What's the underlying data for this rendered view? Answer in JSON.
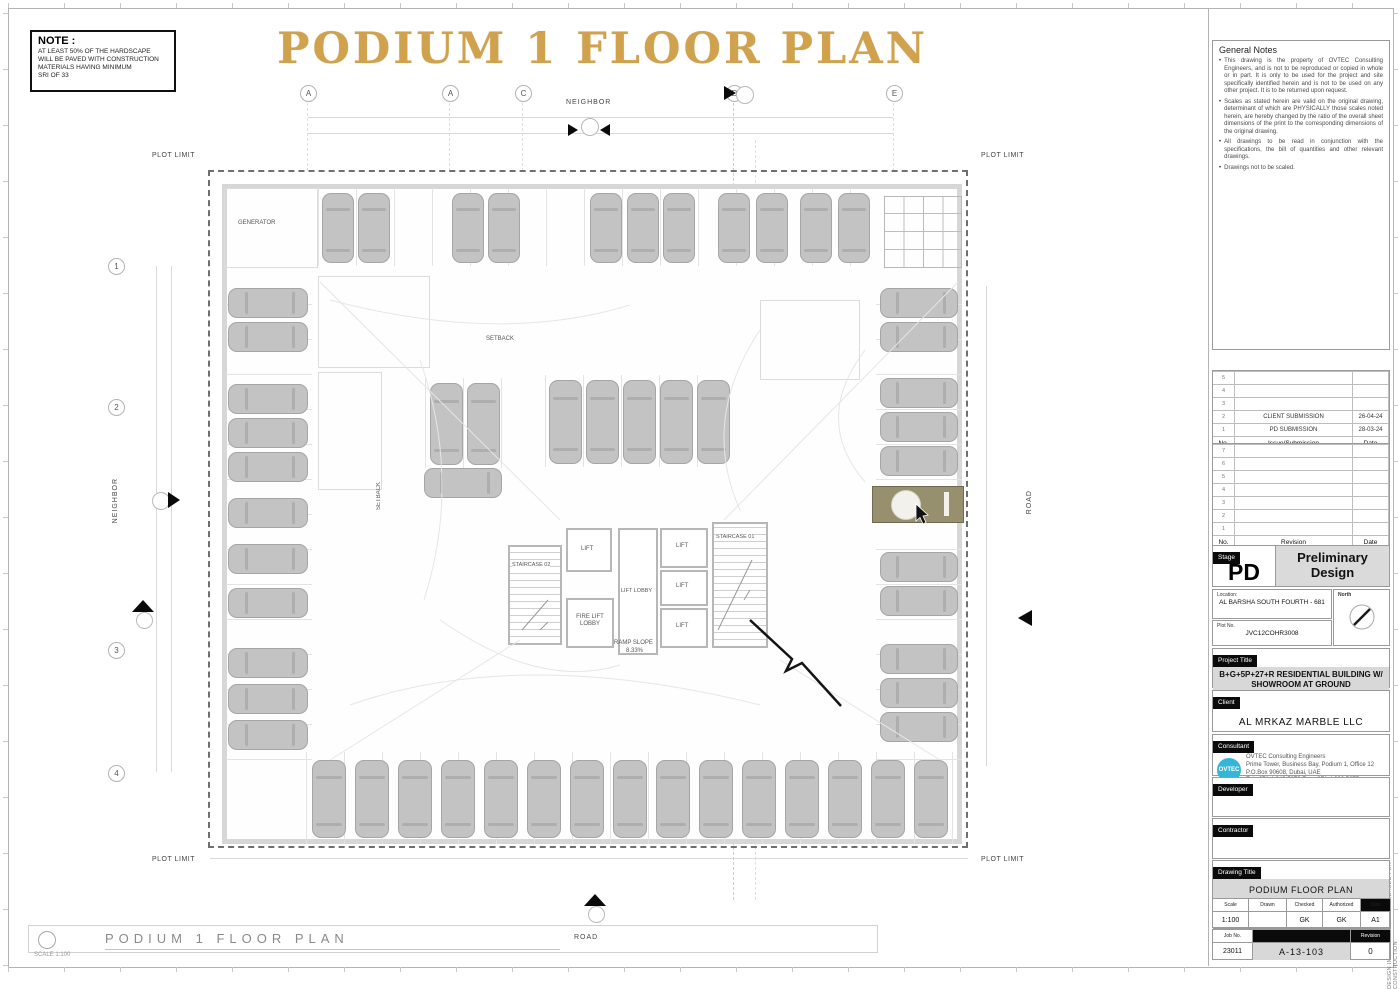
{
  "page": {
    "main_title": "PODIUM 1 FLOOR PLAN",
    "side_note": "DESIGN INTENT ONLY. NOT RELEASED FOR CONSTRUCTION",
    "footer": {
      "title": "PODIUM 1 FLOOR PLAN",
      "scale": "SCALE 1:100"
    }
  },
  "note_box": {
    "title": "NOTE :",
    "lines": [
      "AT LEAST 50% OF THE HARDSCAPE",
      "WILL BE PAVED WITH CONSTRUCTION",
      "MATERIALS HAVING MINIMUM",
      "SRI OF 33"
    ]
  },
  "plan": {
    "grid_top": [
      "A",
      "A",
      "C",
      "D",
      "E"
    ],
    "grid_left": [
      "1",
      "2",
      "3",
      "4"
    ],
    "labels": {
      "neighbor": "NEIGHBOR",
      "road": "ROAD",
      "plot_limit": "PLOT LIMIT",
      "generator": "GENERATOR",
      "setback": "SETBACK",
      "staircase_01": "STAIRCASE 01",
      "staircase_02": "STAIRCASE 02",
      "lift": "LIFT",
      "lift_lobby": "LIFT LOBBY",
      "fire_lift_lobby": "FIRE LIFT LOBBY",
      "ramp_slope_1": "RAMP SLOPE",
      "ramp_slope_2": "8.33%"
    }
  },
  "titleblock": {
    "general_notes": {
      "title": "General Notes",
      "bullets": [
        "This drawing is the property of OVTEC Consulting Engineers, and is not to be reproduced or copied in whole or in part. It is only to be used for the project and site specifically identified herein and is not to be used on any other project. It is to be returned upon request.",
        "Scales as stated herein are valid on the original drawing, determinant of which are PHYSICALLY those scales noted herein, are hereby changed by the ratio of the overall sheet dimensions of the print to the corresponding dimensions of the original drawing.",
        "All drawings to be read in conjunction with the specifications, the bill of quantities and other relevant drawings.",
        "Drawings not to be scaled."
      ]
    },
    "submission": {
      "empty": [
        "5",
        "4",
        "3"
      ],
      "rows": [
        {
          "no": "2",
          "text": "CLIENT  SUBMISSION",
          "date": "26-04-24"
        },
        {
          "no": "1",
          "text": "PD SUBMISSION",
          "date": "28-03-24"
        }
      ],
      "header": {
        "no": "No.",
        "text": "Issue/Submission",
        "date": "Date"
      }
    },
    "revision": {
      "numbers": [
        "7",
        "6",
        "5",
        "4",
        "3",
        "2",
        "1"
      ],
      "header": {
        "no": "No.",
        "text": "Revision",
        "date": "Date"
      }
    },
    "stage": {
      "label": "Stage",
      "code": "PD",
      "name": "Preliminary Design"
    },
    "location": {
      "label": "Location:",
      "value": "AL BARSHA SOUTH FOURTH - 681"
    },
    "north": {
      "label": "North"
    },
    "plot": {
      "label": "Plot No.",
      "value": "JVC12COHR3008"
    },
    "project": {
      "label": "Project Title",
      "value": "B+G+5P+27+R RESIDENTIAL BUILDING W/ SHOWROOM AT GROUND"
    },
    "client": {
      "label": "Client",
      "value": "AL MRKAZ MARBLE LLC"
    },
    "consultant": {
      "label": "Consultant",
      "logo": "OVTEC",
      "lines": [
        "OVTEC Consulting Engineers",
        "Prime Tower, Business Bay, Podium 1, Office 12",
        "P.O.Box 90608, Dubai, UAE",
        "Tel +971 4 343 5679        Fax +971 4 322 5675"
      ]
    },
    "developer": {
      "label": "Developer"
    },
    "contractor": {
      "label": "Contractor"
    },
    "drawing": {
      "label": "Drawing Title",
      "value": "PODIUM  FLOOR PLAN"
    },
    "meta": {
      "scale_label": "Scale",
      "drawn_label": "Drawn",
      "checked_label": "Checked",
      "authorized_label": "Authorized",
      "size_label": "Size",
      "scale": "1:100",
      "drawn": "",
      "checked": "GK",
      "authorized": "GK",
      "size": "A1",
      "job_label": "Job No.",
      "job": "23011",
      "number": "A-13-103",
      "revision_label": "Revision",
      "revision": "0"
    }
  },
  "colors": {
    "title_gold": "#d0a24e",
    "highlight_olive": "#96906e",
    "logo_cyan": "#35b6d9"
  }
}
